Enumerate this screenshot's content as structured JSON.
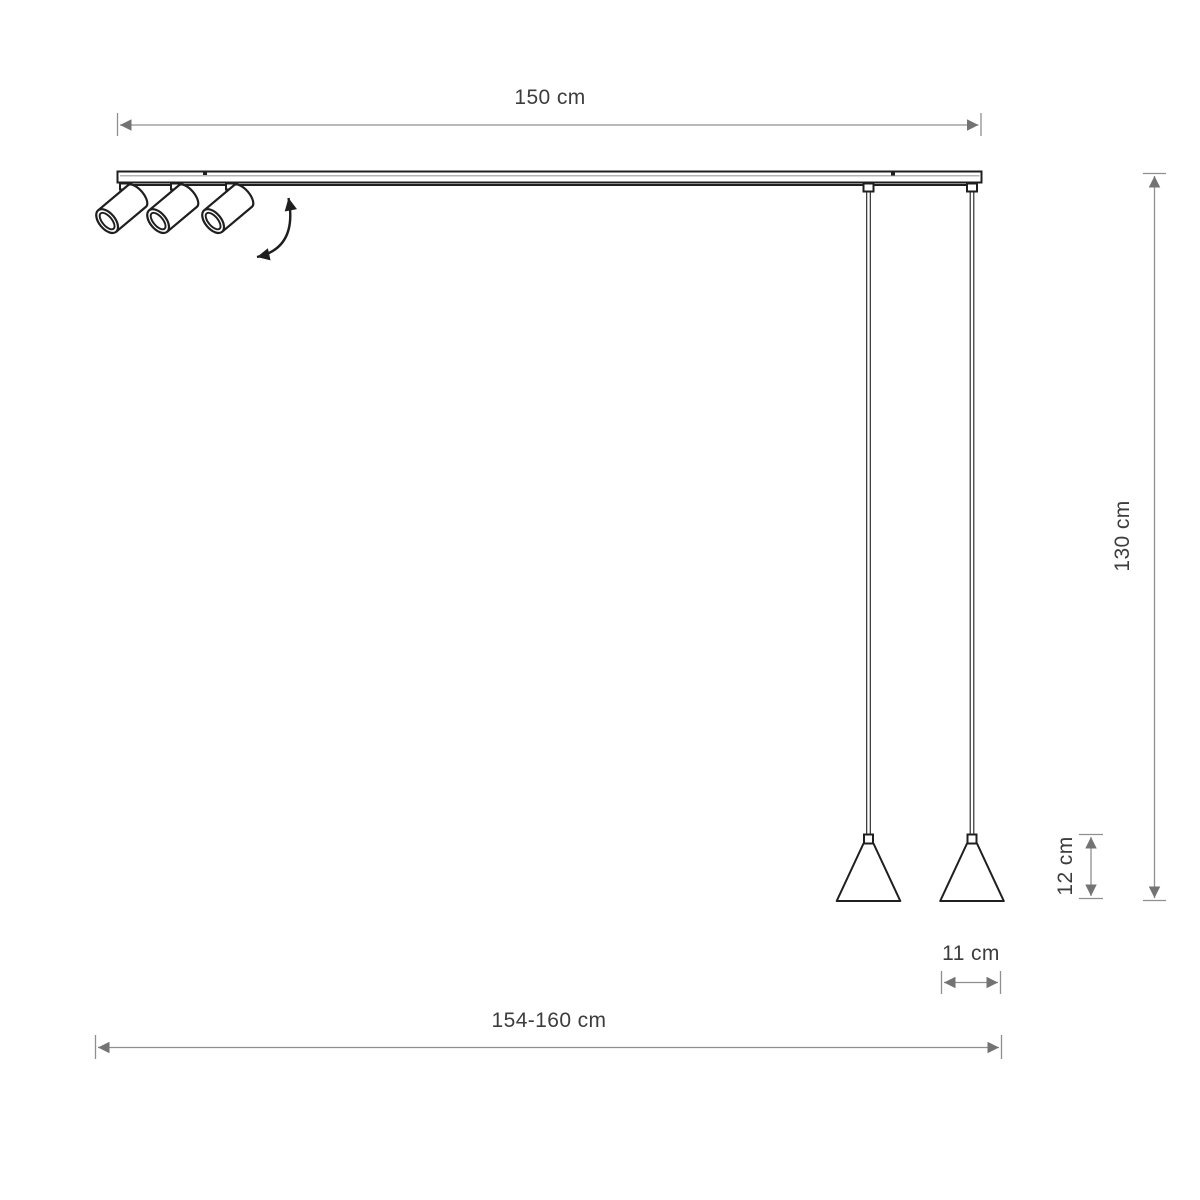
{
  "dimensions": {
    "track_length": "150 cm",
    "overall_length": "154-160 cm",
    "pendant_drop": "130 cm",
    "shade_height": "12 cm",
    "shade_diameter": "11 cm"
  },
  "colors": {
    "background": "#ffffff",
    "outline": "#1f1f1f",
    "dimension_line": "#8f8f8f",
    "dimension_arrow": "#737373",
    "label_text": "#3d3d3d"
  }
}
